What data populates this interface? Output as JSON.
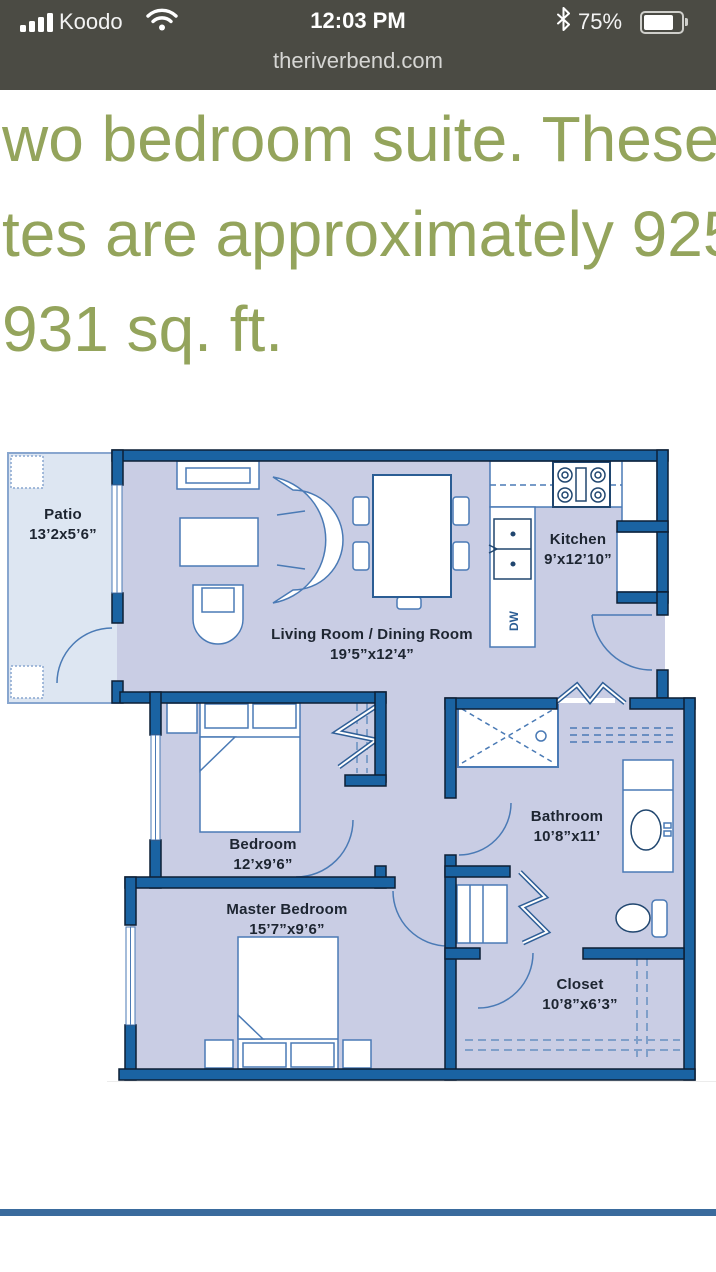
{
  "status_bar": {
    "carrier": "Koodo",
    "time": "12:03 PM",
    "battery_percent": "75%",
    "icons": {
      "signal": "signal-strength-icon (4 bars)",
      "wifi": "wifi-icon",
      "bluetooth": "bluetooth-icon",
      "battery": "battery-icon (about 3/4 full)"
    },
    "bg_color": "#4b4b44"
  },
  "url_bar": {
    "url": "theriverbend.com"
  },
  "description": {
    "lines": [
      "wo bedroom suite. These",
      "tes are approximately 925",
      "931 sq. ft."
    ],
    "color": "#94a45c"
  },
  "floorplan": {
    "rooms": [
      {
        "name": "Patio",
        "dims": "13’2x5’6”"
      },
      {
        "name": "Living Room / Dining Room",
        "dims": "19’5”x12’4”"
      },
      {
        "name": "Kitchen",
        "dims": "9’x12’10”"
      },
      {
        "name": "Bedroom",
        "dims": "12’x9’6”"
      },
      {
        "name": "Bathroom",
        "dims": "10’8”x11’"
      },
      {
        "name": "Master Bedroom",
        "dims": "15’7”x9’6”"
      },
      {
        "name": "Closet",
        "dims": "10’8”x6’3”"
      }
    ],
    "labels": {
      "dishwasher": "DW"
    },
    "colors": {
      "wall": "#1a63a2",
      "room_fill": "#c9cde4",
      "patio_fill": "#dde6f2",
      "line": "#4a7ab5"
    }
  },
  "divider_color": "#3a6b9d"
}
